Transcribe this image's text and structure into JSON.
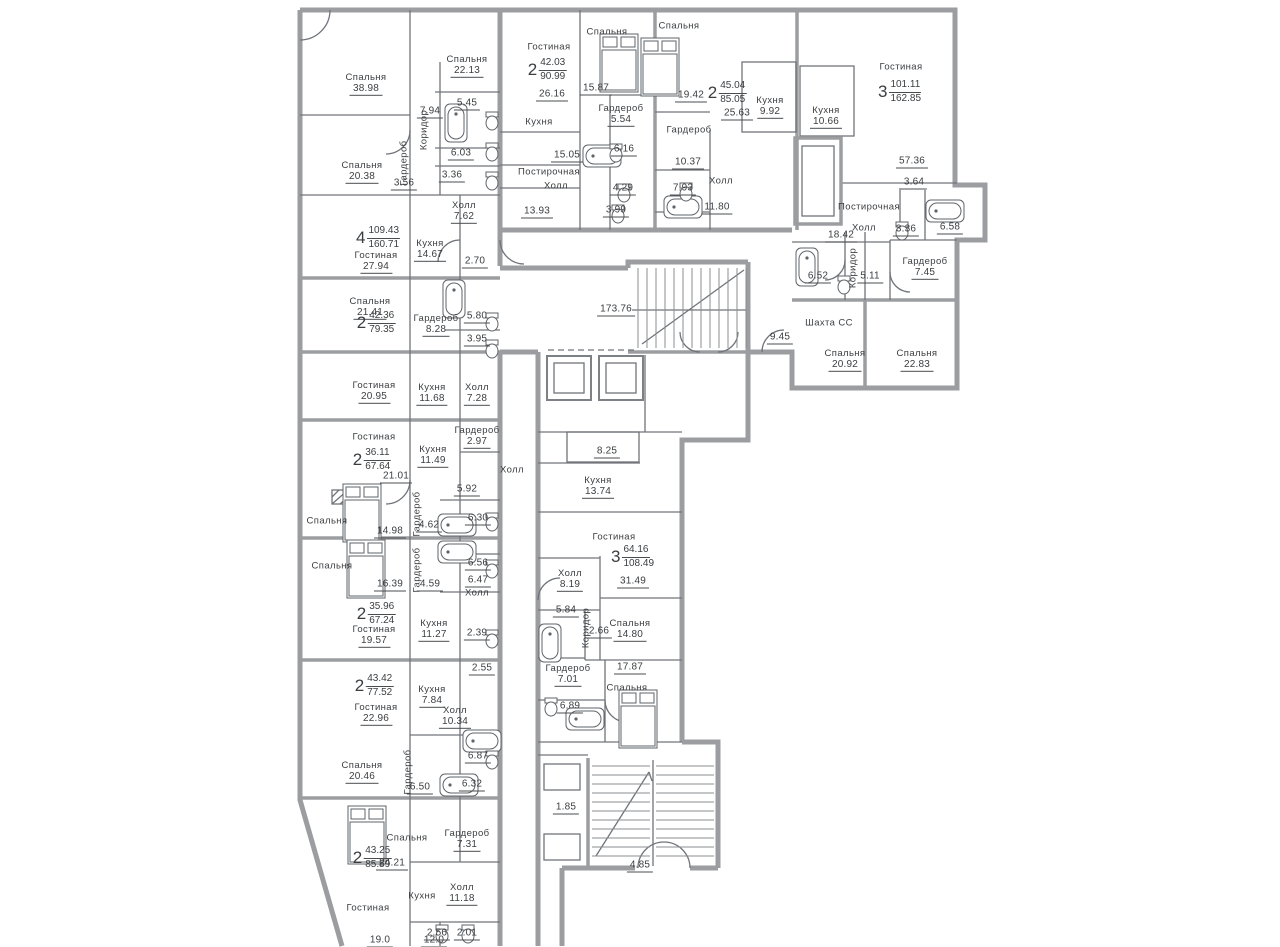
{
  "plan": {
    "colors": {
      "wall": "#9b9da0",
      "line": "#70747a",
      "text": "#3b3e41"
    },
    "shaft_label": "Шахта СС",
    "apartments": [
      {
        "rooms": "4",
        "living": "109.43",
        "total": "160.71",
        "x": 378,
        "y": 238
      },
      {
        "rooms": "2",
        "living": "42.03",
        "total": "90.99",
        "x": 547,
        "y": 70
      },
      {
        "rooms": "2",
        "living": "45.04",
        "total": "85.05",
        "x": 727,
        "y": 93
      },
      {
        "rooms": "3",
        "living": "101.11",
        "total": "162.85",
        "x": 900,
        "y": 92
      },
      {
        "rooms": "2",
        "living": "42.36",
        "total": "79.35",
        "x": 376,
        "y": 323
      },
      {
        "rooms": "2",
        "living": "36.11",
        "total": "67.64",
        "x": 372,
        "y": 460
      },
      {
        "rooms": "2",
        "living": "35.96",
        "total": "67.24",
        "x": 376,
        "y": 614
      },
      {
        "rooms": "2",
        "living": "43.42",
        "total": "77.52",
        "x": 374,
        "y": 686
      },
      {
        "rooms": "2",
        "living": "43.25",
        "total": "85.59",
        "x": 372,
        "y": 858
      },
      {
        "rooms": "3",
        "living": "64.16",
        "total": "108.49",
        "x": 633,
        "y": 557
      }
    ],
    "labels": [
      {
        "n": "Спальня",
        "v": "38.98",
        "x": 366,
        "y": 84
      },
      {
        "n": "Спальня",
        "v": "22.13",
        "x": 467,
        "y": 66
      },
      {
        "n": "Коридор",
        "v": "",
        "x": 424,
        "y": 130,
        "vert": true
      },
      {
        "n": "",
        "v": "7.94",
        "x": 430,
        "y": 112
      },
      {
        "n": "",
        "v": "5.45",
        "x": 467,
        "y": 104
      },
      {
        "n": "",
        "v": "6.03",
        "x": 461,
        "y": 154
      },
      {
        "n": "",
        "v": "3.36",
        "x": 452,
        "y": 176
      },
      {
        "n": "Спальня",
        "v": "20.38",
        "x": 362,
        "y": 172
      },
      {
        "n": "Гардероб",
        "v": "",
        "x": 404,
        "y": 163,
        "vert": true
      },
      {
        "n": "",
        "v": "3.56",
        "x": 404,
        "y": 184
      },
      {
        "n": "Холл",
        "v": "7.62",
        "x": 464,
        "y": 212
      },
      {
        "n": "Гостиная",
        "v": "27.94",
        "x": 376,
        "y": 262
      },
      {
        "n": "Кухня",
        "v": "14.67",
        "x": 430,
        "y": 250
      },
      {
        "n": "",
        "v": "2.70",
        "x": 475,
        "y": 262
      },
      {
        "n": "Спальня",
        "v": "21.41",
        "x": 370,
        "y": 308
      },
      {
        "n": "Гардероб",
        "v": "8.28",
        "x": 436,
        "y": 325
      },
      {
        "n": "",
        "v": "5.80",
        "x": 477,
        "y": 317
      },
      {
        "n": "",
        "v": "3.95",
        "x": 477,
        "y": 340
      },
      {
        "n": "Гостиная",
        "v": "20.95",
        "x": 374,
        "y": 392
      },
      {
        "n": "Кухня",
        "v": "11.68",
        "x": 432,
        "y": 394
      },
      {
        "n": "Холл",
        "v": "7.28",
        "x": 477,
        "y": 394
      },
      {
        "n": "Гостиная",
        "v": "",
        "x": 374,
        "y": 437
      },
      {
        "n": "",
        "v": "21.01",
        "x": 396,
        "y": 477
      },
      {
        "n": "Кухня",
        "v": "11.49",
        "x": 433,
        "y": 456
      },
      {
        "n": "Гардероб",
        "v": "2.97",
        "x": 477,
        "y": 437
      },
      {
        "n": "Холл",
        "v": "",
        "x": 512,
        "y": 470
      },
      {
        "n": "",
        "v": "5.92",
        "x": 467,
        "y": 490
      },
      {
        "n": "Спальня",
        "v": "",
        "x": 327,
        "y": 521
      },
      {
        "n": "",
        "v": "14.98",
        "x": 390,
        "y": 532
      },
      {
        "n": "Гардероб",
        "v": "",
        "x": 417,
        "y": 514,
        "vert": true
      },
      {
        "n": "",
        "v": "4.62",
        "x": 429,
        "y": 526
      },
      {
        "n": "",
        "v": "6.30",
        "x": 478,
        "y": 519
      },
      {
        "n": "Спальня",
        "v": "",
        "x": 332,
        "y": 566
      },
      {
        "n": "",
        "v": "16.39",
        "x": 390,
        "y": 585
      },
      {
        "n": "Гардероб",
        "v": "",
        "x": 417,
        "y": 570,
        "vert": true
      },
      {
        "n": "",
        "v": "4.59",
        "x": 430,
        "y": 585
      },
      {
        "n": "",
        "v": "6.56",
        "x": 478,
        "y": 564
      },
      {
        "n": "",
        "v": "6.47",
        "x": 478,
        "y": 581
      },
      {
        "n": "Холл",
        "v": "",
        "x": 477,
        "y": 593
      },
      {
        "n": "Гостиная",
        "v": "19.57",
        "x": 374,
        "y": 636
      },
      {
        "n": "Кухня",
        "v": "11.27",
        "x": 434,
        "y": 630
      },
      {
        "n": "",
        "v": "2.39",
        "x": 477,
        "y": 634
      },
      {
        "n": "",
        "v": "2.55",
        "x": 482,
        "y": 669
      },
      {
        "n": "Гостиная",
        "v": "22.96",
        "x": 376,
        "y": 714
      },
      {
        "n": "Кухня",
        "v": "7.84",
        "x": 432,
        "y": 696
      },
      {
        "n": "Холл",
        "v": "10.34",
        "x": 455,
        "y": 717
      },
      {
        "n": "",
        "v": "6.87",
        "x": 478,
        "y": 757
      },
      {
        "n": "Спальня",
        "v": "20.46",
        "x": 362,
        "y": 772
      },
      {
        "n": "Гардероб",
        "v": "",
        "x": 408,
        "y": 772,
        "vert": true
      },
      {
        "n": "",
        "v": "6.50",
        "x": 420,
        "y": 788
      },
      {
        "n": "",
        "v": "6.32",
        "x": 472,
        "y": 785
      },
      {
        "n": "Спальня",
        "v": "",
        "x": 407,
        "y": 838
      },
      {
        "n": "",
        "v": "24.21",
        "x": 392,
        "y": 864
      },
      {
        "n": "Гардероб",
        "v": "7.31",
        "x": 467,
        "y": 840
      },
      {
        "n": "Холл",
        "v": "11.18",
        "x": 462,
        "y": 894
      },
      {
        "n": "Гостиная",
        "v": "",
        "x": 368,
        "y": 908
      },
      {
        "n": "",
        "v": "19.0",
        "x": 380,
        "y": 941
      },
      {
        "n": "Кухня",
        "v": "",
        "x": 422,
        "y": 896
      },
      {
        "n": "",
        "v": "12.0",
        "x": 434,
        "y": 941
      },
      {
        "n": "",
        "v": "2.56",
        "x": 437,
        "y": 934
      },
      {
        "n": "",
        "v": "2.01",
        "x": 467,
        "y": 934
      },
      {
        "n": "Гостиная",
        "v": "",
        "x": 549,
        "y": 47
      },
      {
        "n": "",
        "v": "26.16",
        "x": 552,
        "y": 95
      },
      {
        "n": "Спальня",
        "v": "",
        "x": 607,
        "y": 32
      },
      {
        "n": "",
        "v": "15.87",
        "x": 596,
        "y": 89
      },
      {
        "n": "Гардероб",
        "v": "5.54",
        "x": 621,
        "y": 115
      },
      {
        "n": "Кухня",
        "v": "",
        "x": 539,
        "y": 122
      },
      {
        "n": "",
        "v": "15.05",
        "x": 567,
        "y": 156
      },
      {
        "n": "",
        "v": "6.16",
        "x": 624,
        "y": 150
      },
      {
        "n": "Постирочная",
        "v": "",
        "x": 549,
        "y": 172
      },
      {
        "n": "Холл",
        "v": "",
        "x": 556,
        "y": 186
      },
      {
        "n": "",
        "v": "13.93",
        "x": 537,
        "y": 212
      },
      {
        "n": "",
        "v": "4.29",
        "x": 623,
        "y": 189
      },
      {
        "n": "",
        "v": "3.99",
        "x": 616,
        "y": 211
      },
      {
        "n": "Спальня",
        "v": "",
        "x": 679,
        "y": 26
      },
      {
        "n": "",
        "v": "19.42",
        "x": 691,
        "y": 96
      },
      {
        "n": "",
        "v": "25.63",
        "x": 737,
        "y": 114
      },
      {
        "n": "Гардероб",
        "v": "",
        "x": 689,
        "y": 130
      },
      {
        "n": "",
        "v": "10.37",
        "x": 688,
        "y": 163
      },
      {
        "n": "",
        "v": "7.93",
        "x": 683,
        "y": 189
      },
      {
        "n": "Холл",
        "v": "",
        "x": 721,
        "y": 181
      },
      {
        "n": "",
        "v": "11.80",
        "x": 717,
        "y": 208
      },
      {
        "n": "Кухня",
        "v": "9.92",
        "x": 770,
        "y": 107
      },
      {
        "n": "Кухня",
        "v": "10.66",
        "x": 826,
        "y": 117
      },
      {
        "n": "Гостиная",
        "v": "",
        "x": 901,
        "y": 67
      },
      {
        "n": "",
        "v": "57.36",
        "x": 912,
        "y": 162
      },
      {
        "n": "",
        "v": "3.64",
        "x": 914,
        "y": 183
      },
      {
        "n": "Постирочная",
        "v": "",
        "x": 869,
        "y": 207
      },
      {
        "n": "",
        "v": "3.36",
        "x": 906,
        "y": 230
      },
      {
        "n": "",
        "v": "6.58",
        "x": 950,
        "y": 228
      },
      {
        "n": "Холл",
        "v": "",
        "x": 864,
        "y": 228
      },
      {
        "n": "",
        "v": "18.42",
        "x": 841,
        "y": 236
      },
      {
        "n": "Коридор",
        "v": "",
        "x": 853,
        "y": 268,
        "vert": true
      },
      {
        "n": "",
        "v": "5.11",
        "x": 870,
        "y": 277
      },
      {
        "n": "",
        "v": "6.52",
        "x": 818,
        "y": 277
      },
      {
        "n": "Гардероб",
        "v": "7.45",
        "x": 925,
        "y": 268
      },
      {
        "n": "Шахта СС",
        "v": "",
        "x": 829,
        "y": 323
      },
      {
        "n": "",
        "v": "9.45",
        "x": 780,
        "y": 338
      },
      {
        "n": "Спальня",
        "v": "20.92",
        "x": 845,
        "y": 360
      },
      {
        "n": "Спальня",
        "v": "22.83",
        "x": 917,
        "y": 360
      },
      {
        "n": "",
        "v": "173.76",
        "x": 616,
        "y": 310
      },
      {
        "n": "",
        "v": "8.25",
        "x": 607,
        "y": 452
      },
      {
        "n": "Кухня",
        "v": "13.74",
        "x": 598,
        "y": 487
      },
      {
        "n": "Гостиная",
        "v": "",
        "x": 614,
        "y": 537
      },
      {
        "n": "",
        "v": "31.49",
        "x": 633,
        "y": 582
      },
      {
        "n": "Холл",
        "v": "8.19",
        "x": 570,
        "y": 580
      },
      {
        "n": "",
        "v": "5.84",
        "x": 566,
        "y": 611
      },
      {
        "n": "Коридор",
        "v": "",
        "x": 586,
        "y": 628,
        "vert": true
      },
      {
        "n": "",
        "v": "2.66",
        "x": 599,
        "y": 632
      },
      {
        "n": "Спальня",
        "v": "14.80",
        "x": 630,
        "y": 630
      },
      {
        "n": "Гардероб",
        "v": "7.01",
        "x": 568,
        "y": 675
      },
      {
        "n": "",
        "v": "17.87",
        "x": 630,
        "y": 668
      },
      {
        "n": "Спальня",
        "v": "",
        "x": 627,
        "y": 688
      },
      {
        "n": "",
        "v": "6.89",
        "x": 570,
        "y": 707
      },
      {
        "n": "",
        "v": "1.85",
        "x": 566,
        "y": 808
      },
      {
        "n": "",
        "v": "4.85",
        "x": 640,
        "y": 866
      }
    ]
  }
}
